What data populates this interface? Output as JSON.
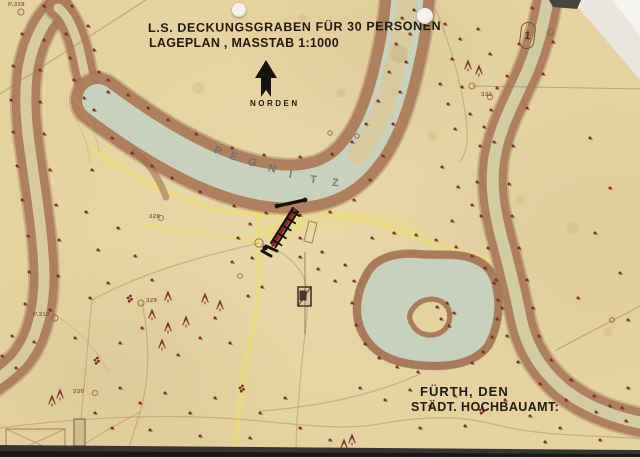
{
  "title": {
    "line1": "L.S. DECKUNGSGRABEN FÜR 30 PERSONEN",
    "line2": "LAGEPLAN , MASSTAB 1:1000"
  },
  "compass": {
    "label": "NORDEN"
  },
  "signature": {
    "line1": "FÜRTH, DEN",
    "line2": "STÄDT. HOCHBAUAMT:"
  },
  "marker": {
    "label": "1"
  },
  "river": {
    "name": "PEGNITZ",
    "letters": [
      {
        "ch": "P",
        "x": 214,
        "y": 145,
        "r": 18
      },
      {
        "ch": "E",
        "x": 230,
        "y": 151,
        "r": 17
      },
      {
        "ch": "G",
        "x": 248,
        "y": 157,
        "r": 15
      },
      {
        "ch": "N",
        "x": 268,
        "y": 163,
        "r": 12
      },
      {
        "ch": "I",
        "x": 289,
        "y": 169,
        "r": 10
      },
      {
        "ch": "T",
        "x": 310,
        "y": 174,
        "r": 6
      },
      {
        "ch": "Z",
        "x": 332,
        "y": 177,
        "r": 3
      }
    ]
  },
  "survey_points": [
    {
      "label": "P.319",
      "x": 8,
      "y": 2
    },
    {
      "label": "P.310",
      "x": 33,
      "y": 312
    },
    {
      "label": "328",
      "x": 149,
      "y": 214
    },
    {
      "label": "329",
      "x": 146,
      "y": 298
    },
    {
      "label": "330",
      "x": 73,
      "y": 389
    },
    {
      "label": "332",
      "x": 481,
      "y": 92
    }
  ],
  "colors": {
    "paper": "#e5d2a0",
    "ink": "#201a10",
    "bank": "#b58868",
    "bank_dark": "#8a5a3c",
    "water_green": "#c9d1bd",
    "water_tan": "#d7caa0",
    "water_pale": "#d3cba4",
    "path_yellow": "#eede74",
    "tree": "#7a3127",
    "label_blue": "#6a7482"
  },
  "geometry": {
    "yellow": [
      {
        "d": "M 92,148 C 135,180 180,201 225,211 C 255,216 290,217 320,211",
        "w": 6,
        "o": 0.5
      },
      {
        "d": "M 320,211 C 355,216 390,227 420,239 C 448,250 472,256 492,261",
        "w": 6,
        "o": 0.5
      },
      {
        "d": "M 262,206 C 256,224 256,242 258,258 C 262,284 258,312 250,340 C 243,370 239,402 237,430 L 235,458",
        "w": 6,
        "o": 0.5
      },
      {
        "d": "M 148,226 C 186,231 222,236 256,241",
        "w": 5,
        "o": 0.45
      },
      {
        "d": "M 268,231 C 300,223 335,218 372,219 C 392,220 406,225 418,232",
        "w": 11,
        "o": 0.28
      }
    ],
    "yellow_blob": {
      "cx": 284,
      "cy": 229,
      "rx": 24,
      "ry": 11,
      "rot": -18,
      "o": 0.3
    },
    "rivers": [
      {
        "d": "M 58,8 C 45,18 33,40 28,68 C 24,95 26,122 30,150 C 36,195 44,240 44,280 C 43,318 34,344 18,362 C 6,374 -6,382 -16,388",
        "bank": 28,
        "water": 11,
        "wc": "water_tan"
      },
      {
        "d": "M 58,8 C 70,16 78,40 83,66 C 87,86 93,100 104,112",
        "bank": 24,
        "water": 9,
        "wc": "water_tan"
      },
      {
        "d": "M 98,100 C 130,124 163,146 199,163 C 235,180 270,189 302,186 C 330,183 348,171 362,152 C 380,129 391,93 398,60 C 404,35 407,10 408,-12",
        "bank": 54,
        "water": 32,
        "wc": "water_green"
      },
      {
        "d": "M 358,155 C 376,133 389,96 397,60 C 403,36 406,12 407,-10",
        "bank": 0,
        "water": 20,
        "wc": "water_tan"
      },
      {
        "d": "M 549,-10 C 545,20 538,45 528,70 C 515,100 502,122 496,150 C 489,180 494,210 502,240 C 510,270 516,295 521,320 C 527,348 541,370 562,388 C 584,406 614,418 648,424",
        "bank": 28,
        "water": 12,
        "wc": "water_pale"
      }
    ],
    "pond": "M 368,272 C 376,258 396,252 418,254 C 440,256 458,252 476,260 C 492,267 496,280 498,296 C 500,314 496,332 488,346 C 477,360 458,366 436,366 C 412,366 390,362 376,350 C 362,338 356,322 357,306 C 358,292 362,282 368,272 Z",
    "island": "M 412,310 C 418,300 432,296 442,302 C 452,308 452,322 444,330 C 435,338 420,336 414,327 C 409,320 408,316 412,310 Z",
    "slope": "M 134,152 C 150,163 159,179 166,197",
    "contours": [
      "M 75,98 C 88,115 96,132 99,152",
      "M 66,104 C 79,122 88,142 90,162",
      "M 60,318 C 80,332 98,350 108,372"
    ],
    "faint": [
      "M 0,428 C 90,416 180,413 260,421 C 330,428 355,429 385,423 C 445,413 475,419 505,427 C 552,437 600,435 642,439",
      "M 259,243 C 230,250 200,257 170,267 C 140,277 114,288 92,300",
      "M 262,244 C 285,252 299,264 305,281 C 310,296 307,314 305,333 C 302,361 299,391 297,421 C 296,441 296,451 296,458",
      "M 420,374 C 398,384 374,392 348,398 C 318,405 288,409 260,411",
      "M 436,10 C 449,42 461,80 466,118 C 469,140 467,152 460,162",
      "M 92,300 C 88,340 85,380 81,418",
      "M 142,303 C 150,340 150,378 140,412 C 136,426 130,444 126,458",
      "M 65,456 C 90,440 110,428 140,412"
    ],
    "survey_lines": [
      "M 0,94 L 152,-4",
      "M 472,86 L 646,89",
      "M 646,303 L 556,350"
    ],
    "marks": [
      {
        "d": "M 6,429 L 65,429 L 65,456 L 6,456 Z",
        "w": 1,
        "o": 0.7
      },
      {
        "d": "M 6,456 L 65,429 M 6,429 L 65,456",
        "w": 0.8,
        "o": 0.5
      },
      {
        "d": "M 74,419 L 85,419 L 85,446 L 74,446 Z",
        "w": 1.2,
        "o": 0.85,
        "f": "#cdbd8e"
      },
      {
        "d": "M 298,287 L 311,287 L 311,306 L 298,306 Z",
        "w": 1.6,
        "o": 0.9,
        "s": "#2e241c",
        "f": "#d9c89a"
      },
      {
        "d": "M 298,306 L 311,287",
        "w": 1.1,
        "o": 0.8,
        "s": "#2e241c"
      },
      {
        "d": "M 300,291 L 306,291 L 306,300 L 300,300 Z",
        "w": 1,
        "o": 0.9,
        "s": "#2e241c",
        "f": "#3a2c20"
      },
      {
        "d": "M 305,252 L 305,334",
        "w": 0.9,
        "o": 0.6,
        "s": "#5a4030"
      },
      {
        "d": "M 309,221 l 8,2 l -5,20 l -8,-2 Z",
        "w": 1,
        "o": 0.7
      }
    ],
    "circles": [
      [
        21,
        12,
        3
      ],
      [
        55,
        318,
        3
      ],
      [
        161,
        218,
        2.5
      ],
      [
        141,
        303,
        3
      ],
      [
        95,
        393,
        2.5
      ],
      [
        472,
        86,
        3
      ],
      [
        551,
        32,
        3
      ],
      [
        330,
        133,
        2.2
      ],
      [
        357,
        136,
        2.2
      ],
      [
        259,
        243,
        4.2
      ],
      [
        240,
        276,
        2.4
      ],
      [
        612,
        320,
        2.4
      ],
      [
        490,
        97,
        2.6
      ]
    ],
    "foxing": [
      [
        399,
        54,
        9
      ],
      [
        341,
        93,
        5
      ],
      [
        573,
        228,
        6
      ],
      [
        608,
        332,
        5
      ],
      [
        302,
        18,
        4
      ],
      [
        432,
        136,
        5
      ],
      [
        198,
        88,
        6
      ],
      [
        520,
        200,
        5
      ]
    ],
    "trench": {
      "red": "M 295,210 L 273,245",
      "rail1": "M 297.5,212 L 275.5,247",
      "rail2": "M 293,208 L 271,243",
      "top": "M 277,206 L 305,200",
      "top_red": "M 280,206.5 L 302,201.5",
      "tickA": [
        297.5,
        210
      ],
      "tickB": [
        275.5,
        245.5
      ],
      "ticks": [
        0.1,
        0.3,
        0.5,
        0.72,
        0.92
      ],
      "bottom": [
        "M 266,246 L 277,251",
        "M 262,251 L 271,256"
      ],
      "blobs": [
        [
          277,
          206,
          2.4
        ],
        [
          305,
          200,
          2.4
        ],
        [
          265,
          248,
          2.6
        ],
        [
          297,
          212,
          1.8
        ]
      ]
    },
    "trees": [
      [
        108,
        80,
        0
      ],
      [
        128,
        95,
        0
      ],
      [
        148,
        108,
        0
      ],
      [
        168,
        120,
        0
      ],
      [
        196,
        134,
        0
      ],
      [
        232,
        148,
        0
      ],
      [
        264,
        155,
        0
      ],
      [
        300,
        157,
        0
      ],
      [
        332,
        154,
        0
      ],
      [
        352,
        142,
        0
      ],
      [
        366,
        124,
        0
      ],
      [
        378,
        101,
        0
      ],
      [
        389,
        72,
        0
      ],
      [
        396,
        44,
        0
      ],
      [
        402,
        18,
        0
      ],
      [
        112,
        138,
        0
      ],
      [
        132,
        153,
        0
      ],
      [
        152,
        166,
        0
      ],
      [
        172,
        178,
        0
      ],
      [
        200,
        192,
        0
      ],
      [
        234,
        206,
        0
      ],
      [
        266,
        213,
        0
      ],
      [
        300,
        215,
        0
      ],
      [
        330,
        212,
        0
      ],
      [
        354,
        200,
        0
      ],
      [
        370,
        180,
        0
      ],
      [
        383,
        156,
        0
      ],
      [
        393,
        124,
        0
      ],
      [
        400,
        92,
        0
      ],
      [
        406,
        62,
        0
      ],
      [
        410,
        34,
        0
      ],
      [
        414,
        10,
        0
      ],
      [
        44,
        6,
        0
      ],
      [
        22,
        34,
        0
      ],
      [
        13,
        66,
        0
      ],
      [
        11,
        100,
        0
      ],
      [
        13,
        132,
        0
      ],
      [
        17,
        166,
        0
      ],
      [
        22,
        200,
        0
      ],
      [
        28,
        236,
        0
      ],
      [
        29,
        272,
        0
      ],
      [
        25,
        304,
        0
      ],
      [
        12,
        336,
        0
      ],
      [
        2,
        356,
        0
      ],
      [
        44,
        40,
        0
      ],
      [
        40,
        70,
        0
      ],
      [
        40,
        102,
        0
      ],
      [
        44,
        134,
        0
      ],
      [
        50,
        170,
        0
      ],
      [
        56,
        205,
        0
      ],
      [
        59,
        240,
        0
      ],
      [
        58,
        276,
        0
      ],
      [
        50,
        310,
        0
      ],
      [
        34,
        342,
        0
      ],
      [
        16,
        368,
        0
      ],
      [
        66,
        34,
        0
      ],
      [
        70,
        58,
        0
      ],
      [
        74,
        80,
        0
      ],
      [
        84,
        98,
        0
      ],
      [
        94,
        110,
        0
      ],
      [
        72,
        6,
        0
      ],
      [
        88,
        26,
        0
      ],
      [
        94,
        50,
        0
      ],
      [
        99,
        72,
        0
      ],
      [
        108,
        92,
        0
      ],
      [
        532,
        8,
        0
      ],
      [
        519,
        44,
        0
      ],
      [
        507,
        76,
        0
      ],
      [
        491,
        110,
        0
      ],
      [
        480,
        146,
        0
      ],
      [
        477,
        182,
        0
      ],
      [
        481,
        216,
        0
      ],
      [
        488,
        248,
        0
      ],
      [
        496,
        280,
        0
      ],
      [
        502,
        308,
        0
      ],
      [
        507,
        336,
        0
      ],
      [
        518,
        362,
        0
      ],
      [
        540,
        384,
        0
      ],
      [
        566,
        400,
        0
      ],
      [
        596,
        412,
        0
      ],
      [
        626,
        421,
        0
      ],
      [
        565,
        6,
        0
      ],
      [
        553,
        42,
        0
      ],
      [
        543,
        74,
        0
      ],
      [
        527,
        108,
        0
      ],
      [
        513,
        146,
        0
      ],
      [
        509,
        184,
        0
      ],
      [
        512,
        216,
        0
      ],
      [
        519,
        248,
        0
      ],
      [
        527,
        280,
        0
      ],
      [
        533,
        308,
        0
      ],
      [
        539,
        336,
        0
      ],
      [
        551,
        360,
        0
      ],
      [
        571,
        380,
        0
      ],
      [
        594,
        396,
        0
      ],
      [
        622,
        408,
        0
      ],
      [
        372,
        238,
        0
      ],
      [
        394,
        233,
        0
      ],
      [
        416,
        235,
        0
      ],
      [
        436,
        240,
        0
      ],
      [
        456,
        247,
        0
      ],
      [
        472,
        256,
        0
      ],
      [
        485,
        268,
        0
      ],
      [
        494,
        283,
        0
      ],
      [
        498,
        300,
        0
      ],
      [
        497,
        319,
        0
      ],
      [
        492,
        337,
        0
      ],
      [
        483,
        352,
        0
      ],
      [
        472,
        363,
        0
      ],
      [
        354,
        281,
        0
      ],
      [
        352,
        303,
        0
      ],
      [
        356,
        325,
        0
      ],
      [
        365,
        344,
        0
      ],
      [
        379,
        358,
        0
      ],
      [
        397,
        367,
        0
      ],
      [
        418,
        372,
        0
      ],
      [
        437,
        307,
        0
      ],
      [
        447,
        303,
        0
      ],
      [
        454,
        313,
        0
      ],
      [
        441,
        319,
        0
      ],
      [
        449,
        326,
        0
      ],
      [
        445,
        24,
        0
      ],
      [
        460,
        39,
        0
      ],
      [
        478,
        29,
        0
      ],
      [
        452,
        59,
        0
      ],
      [
        468,
        69,
        1
      ],
      [
        479,
        74,
        1
      ],
      [
        462,
        87,
        0
      ],
      [
        448,
        104,
        0
      ],
      [
        470,
        114,
        0
      ],
      [
        484,
        127,
        0
      ],
      [
        455,
        129,
        0
      ],
      [
        440,
        84,
        0
      ],
      [
        490,
        54,
        0
      ],
      [
        497,
        88,
        0
      ],
      [
        494,
        142,
        0
      ],
      [
        442,
        167,
        0
      ],
      [
        458,
        187,
        0
      ],
      [
        472,
        205,
        0
      ],
      [
        452,
        221,
        0
      ],
      [
        590,
        138,
        0
      ],
      [
        610,
        188,
        0
      ],
      [
        595,
        233,
        0
      ],
      [
        620,
        273,
        0
      ],
      [
        578,
        298,
        0
      ],
      [
        628,
        320,
        0
      ],
      [
        92,
        170,
        0
      ],
      [
        86,
        212,
        0
      ],
      [
        98,
        250,
        0
      ],
      [
        118,
        228,
        0
      ],
      [
        135,
        256,
        0
      ],
      [
        108,
        283,
        0
      ],
      [
        90,
        298,
        0
      ],
      [
        128,
        298,
        2
      ],
      [
        152,
        280,
        0
      ],
      [
        168,
        300,
        1
      ],
      [
        75,
        338,
        0
      ],
      [
        95,
        360,
        2
      ],
      [
        120,
        343,
        0
      ],
      [
        142,
        328,
        0
      ],
      [
        152,
        318,
        1
      ],
      [
        168,
        331,
        1
      ],
      [
        186,
        325,
        1
      ],
      [
        162,
        348,
        1
      ],
      [
        178,
        355,
        0
      ],
      [
        200,
        338,
        0
      ],
      [
        215,
        318,
        0
      ],
      [
        230,
        343,
        0
      ],
      [
        205,
        302,
        1
      ],
      [
        220,
        309,
        1
      ],
      [
        120,
        388,
        0
      ],
      [
        140,
        403,
        0
      ],
      [
        165,
        393,
        0
      ],
      [
        190,
        413,
        0
      ],
      [
        215,
        398,
        0
      ],
      [
        240,
        388,
        2
      ],
      [
        260,
        413,
        0
      ],
      [
        285,
        398,
        0
      ],
      [
        112,
        428,
        0
      ],
      [
        150,
        430,
        0
      ],
      [
        200,
        436,
        0
      ],
      [
        250,
        438,
        0
      ],
      [
        300,
        428,
        0
      ],
      [
        330,
        440,
        0
      ],
      [
        95,
        413,
        0
      ],
      [
        60,
        398,
        1
      ],
      [
        52,
        404,
        1
      ],
      [
        248,
        296,
        0
      ],
      [
        262,
        287,
        0
      ],
      [
        300,
        257,
        0
      ],
      [
        318,
        269,
        0
      ],
      [
        335,
        281,
        0
      ],
      [
        252,
        258,
        0
      ],
      [
        232,
        262,
        0
      ],
      [
        360,
        388,
        0
      ],
      [
        385,
        400,
        0
      ],
      [
        410,
        390,
        0
      ],
      [
        430,
        406,
        0
      ],
      [
        455,
        396,
        0
      ],
      [
        480,
        410,
        2
      ],
      [
        505,
        400,
        0
      ],
      [
        530,
        416,
        0
      ],
      [
        352,
        443,
        1
      ],
      [
        344,
        448,
        1
      ],
      [
        420,
        428,
        0
      ],
      [
        465,
        426,
        0
      ],
      [
        560,
        428,
        0
      ],
      [
        610,
        406,
        0
      ],
      [
        628,
        388,
        0
      ],
      [
        600,
        440,
        0
      ],
      [
        545,
        442,
        0
      ],
      [
        250,
        224,
        0
      ],
      [
        238,
        238,
        0
      ],
      [
        300,
        238,
        0
      ],
      [
        322,
        252,
        0
      ],
      [
        345,
        265,
        0
      ]
    ]
  }
}
